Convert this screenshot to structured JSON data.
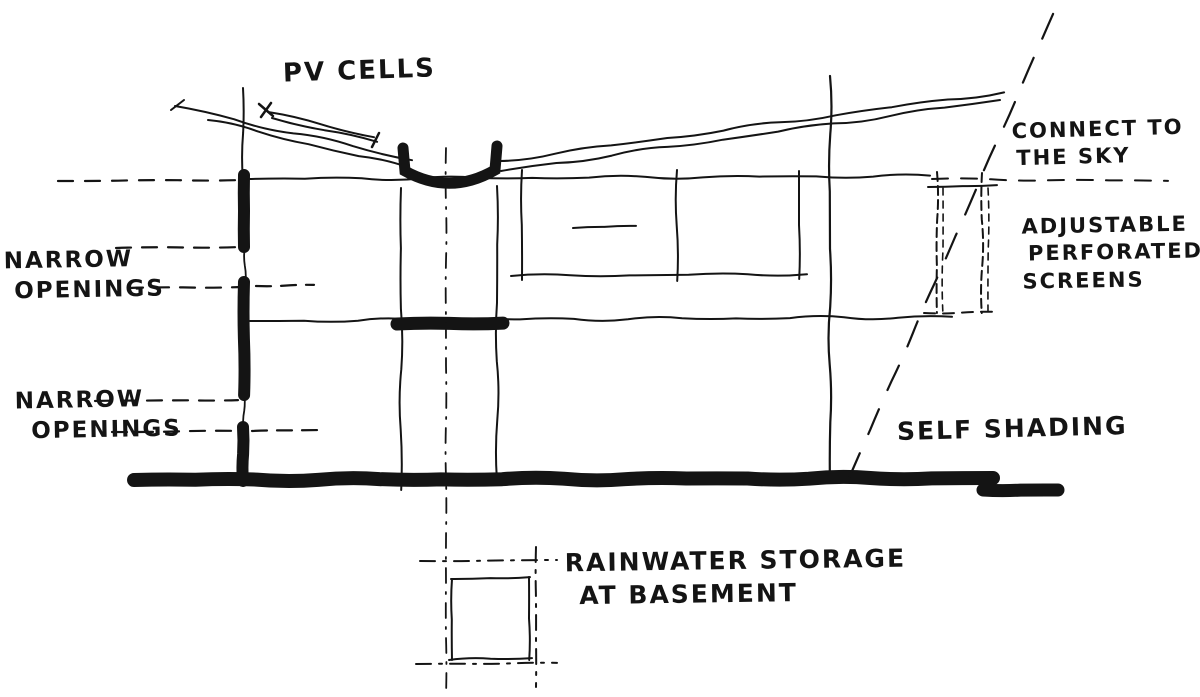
{
  "colors": {
    "ink": "#141414",
    "paper": "#ffffff"
  },
  "annotations": {
    "pv_cells": "PV CELLS",
    "connect_to_the_sky": {
      "line1": "CONNECT TO",
      "line2": "THE SKY"
    },
    "adjustable_perforated_screens": {
      "line1": "ADJUSTABLE",
      "line2": "PERFORATED",
      "line3": "SCREENS"
    },
    "narrow_openings_upper": {
      "line1": "NARROW",
      "line2": "OPENINGS"
    },
    "narrow_openings_lower": {
      "line1": "NARROW",
      "line2": "OPENINGS"
    },
    "self_shading": "SELF SHADING",
    "rainwater_storage": {
      "line1": "RAINWATER STORAGE",
      "line2": "AT BASEMENT"
    }
  }
}
